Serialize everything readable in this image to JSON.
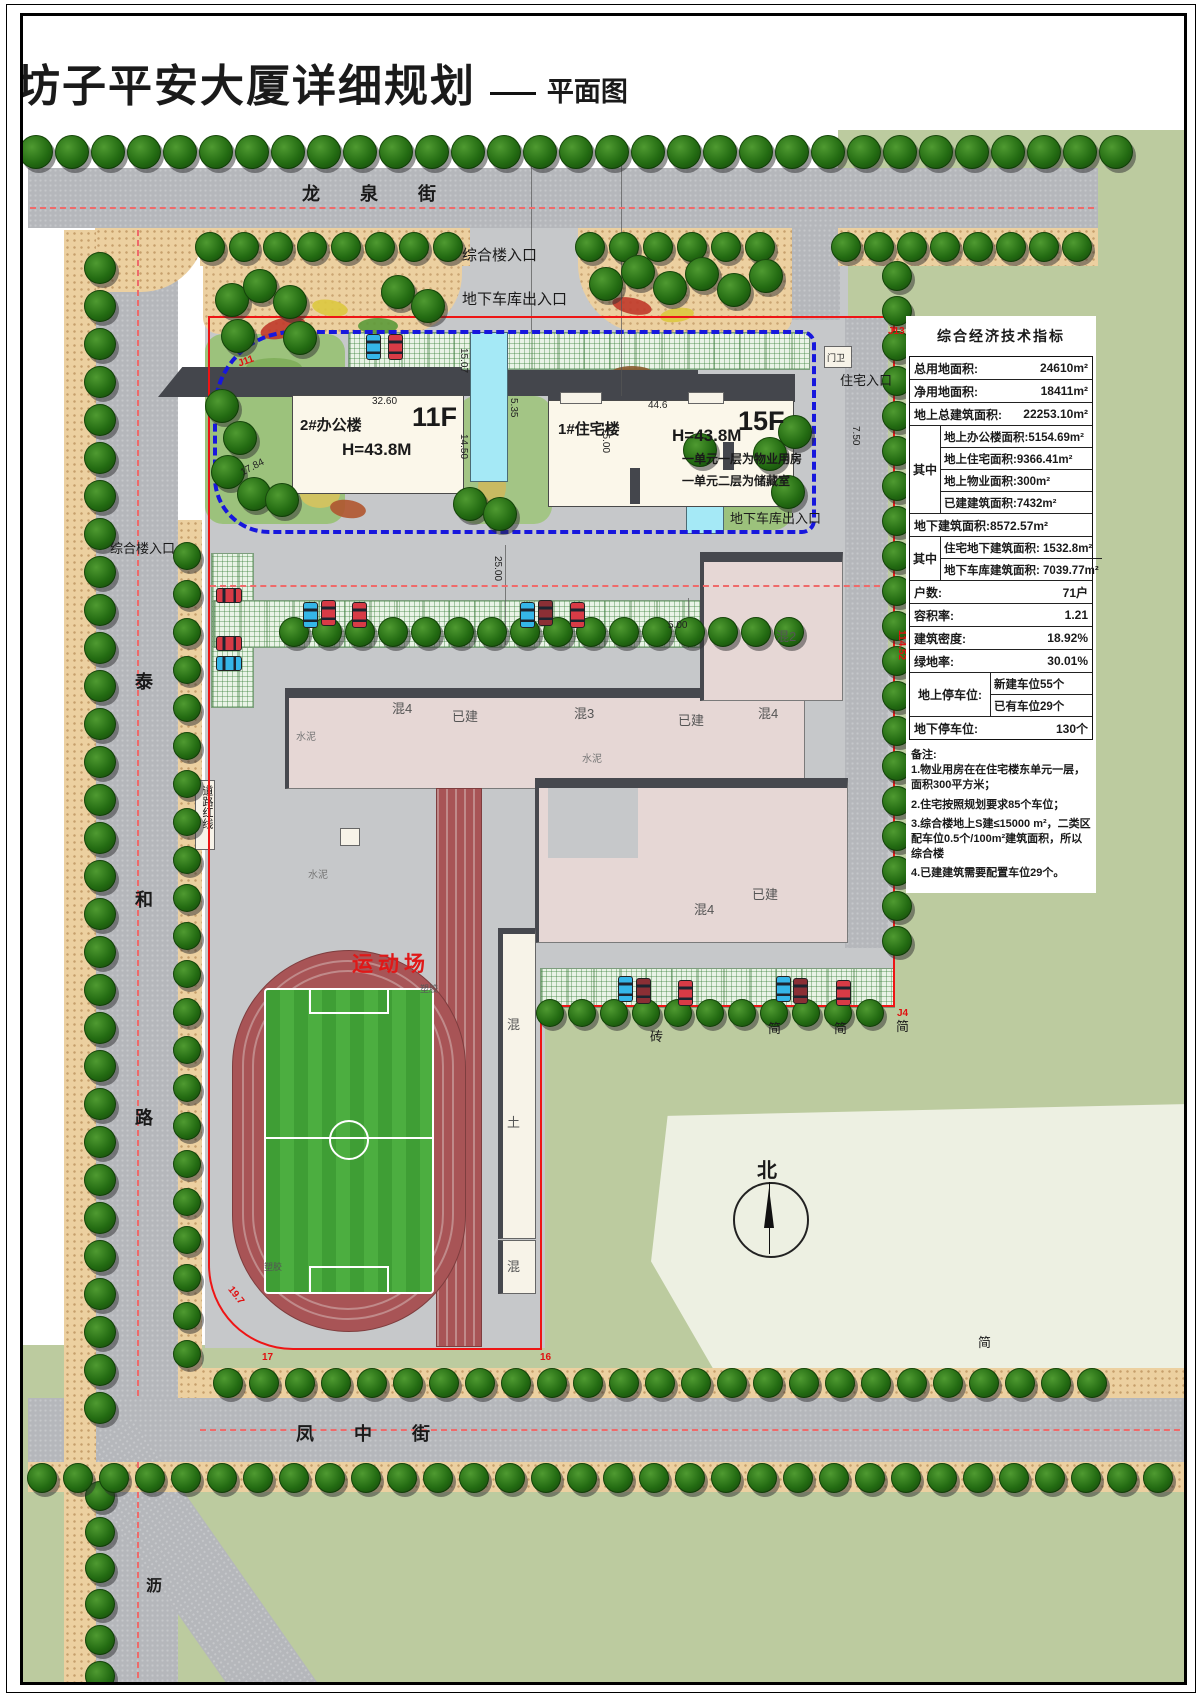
{
  "title": {
    "main": "坊子平安大厦详细规划",
    "suffix": "平面图"
  },
  "streets": {
    "north": "龙泉街",
    "west": "泰和路",
    "south": "凤中街",
    "southwest": "沥"
  },
  "buildings": {
    "office": {
      "name": "2#办公楼",
      "floors": "11F",
      "height": "H=43.8M"
    },
    "residence": {
      "name": "1#住宅楼",
      "floors": "15F",
      "height": "H=43.8M",
      "note1": "一单元一层为物业用房",
      "note2": "一单元二层为储藏室"
    },
    "row": [
      "混4",
      "已建",
      "混3",
      "已建",
      "混4"
    ],
    "ne": "混2",
    "south_a": "已建",
    "south_b": "混4",
    "strip": [
      "混",
      "土",
      "混"
    ]
  },
  "labels": {
    "entry_top": "综合楼入口",
    "garage_top": "地下车库出入口",
    "garage_east": "地下车库出入口",
    "gate": "门卫",
    "resident_entry": "住宅入口",
    "entry_west": "综合楼入口",
    "road_red_line": "道路红线",
    "stadium": "运动场",
    "north": "北",
    "cement": "水泥",
    "brick": "砖",
    "shed": "简",
    "plastic": "塑胶"
  },
  "dims": {
    "w3260": "32.60",
    "w1784": "17.84",
    "w1507": "15.07",
    "w1450": "14.50",
    "w535": "5.35",
    "w446": "44.6",
    "w1500": "15.00",
    "w2500": "25.00",
    "w500": "5.00",
    "w750": "7.50"
  },
  "marks": {
    "j11": "J11",
    "j13": "J13",
    "j4": "J4",
    "len": "114.52",
    "arc": "19.7",
    "m16": "16",
    "m17": "17"
  },
  "table": {
    "title": "综合经济技术指标",
    "rows": [
      {
        "label": "总用地面积:",
        "value": "24610m²"
      },
      {
        "label": "净用地面积:",
        "value": "18411m²"
      },
      {
        "label": "地上总建筑面积:",
        "value": "22253.10m²"
      },
      {
        "group": "其中",
        "items": [
          "地上办公楼面积:5154.69m²",
          "地上住宅面积:9366.41m²",
          "地上物业面积:300m²",
          "已建建筑面积:7432m²"
        ]
      },
      {
        "label": "地下建筑面积:8572.57m²",
        "value": ""
      },
      {
        "group": "其中",
        "items": [
          "住宅地下建筑面积: 1532.8m²",
          "地下车库建筑面积: 7039.77m²"
        ]
      },
      {
        "label": "户数:",
        "value": "71户"
      },
      {
        "label": "容积率:",
        "value": "1.21"
      },
      {
        "label": "建筑密度:",
        "value": "18.92%"
      },
      {
        "label": "绿地率:",
        "value": "30.01%"
      },
      {
        "group": "地上停车位:",
        "items": [
          "新建车位55个",
          "已有车位29个"
        ]
      },
      {
        "label": "地下停车位:",
        "value": "130个"
      }
    ],
    "notes_title": "备注:",
    "notes": [
      "1.物业用房在在住宅楼东单元一层，面积300平方米；",
      "2.住宅按照规划要求85个车位；",
      "3.综合楼地上S建≤15000 m²，二类区配车位0.5个/100m²建筑面积，所以综合楼",
      "4.已建建筑需要配置车位29个。"
    ]
  }
}
